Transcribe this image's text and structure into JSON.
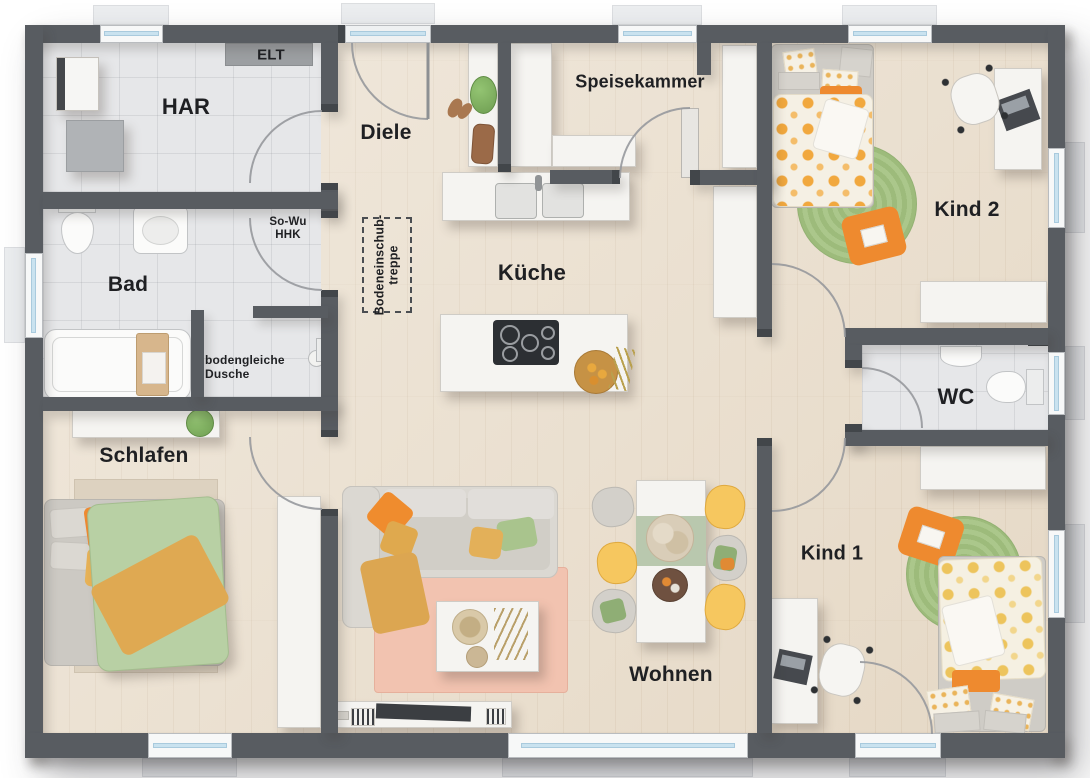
{
  "plan": {
    "type": "floor-plan",
    "style": "top-down furnished bungalow layout",
    "rooms": {
      "har": "HAR",
      "elt": "ELT",
      "diele": "Diele",
      "speisekammer": "Speisekammer",
      "kind2": "Kind 2",
      "bad": "Bad",
      "kueche": "Küche",
      "wc": "WC",
      "schlafen": "Schlafen",
      "kind1": "Kind 1",
      "wohnen": "Wohnen"
    },
    "annotations": {
      "so_wu_line1": "So-Wu",
      "so_wu_line2": "HHK",
      "dusche_line1": "bodengleiche",
      "dusche_line2": "Dusche",
      "treppe_line1": "Bodeneinschub-",
      "treppe_line2": "treppe"
    },
    "colors": {
      "wall": "#585c61",
      "wood_floor": "#eadfce",
      "tile_floor": "#e6e7e9",
      "furniture_white": "#f5f4f1",
      "accent_orange": "#ee8a2f",
      "accent_mustard": "#dfa94e",
      "accent_yellow_chair": "#f6c75f",
      "accent_sage": "#a9c48d",
      "duvet_green": "#b8d0a4",
      "rug_green": "#a6c487",
      "rug_pink": "#f2c3b0",
      "window_glass": "#c9e2ef",
      "label_text": "#1f2023"
    }
  }
}
